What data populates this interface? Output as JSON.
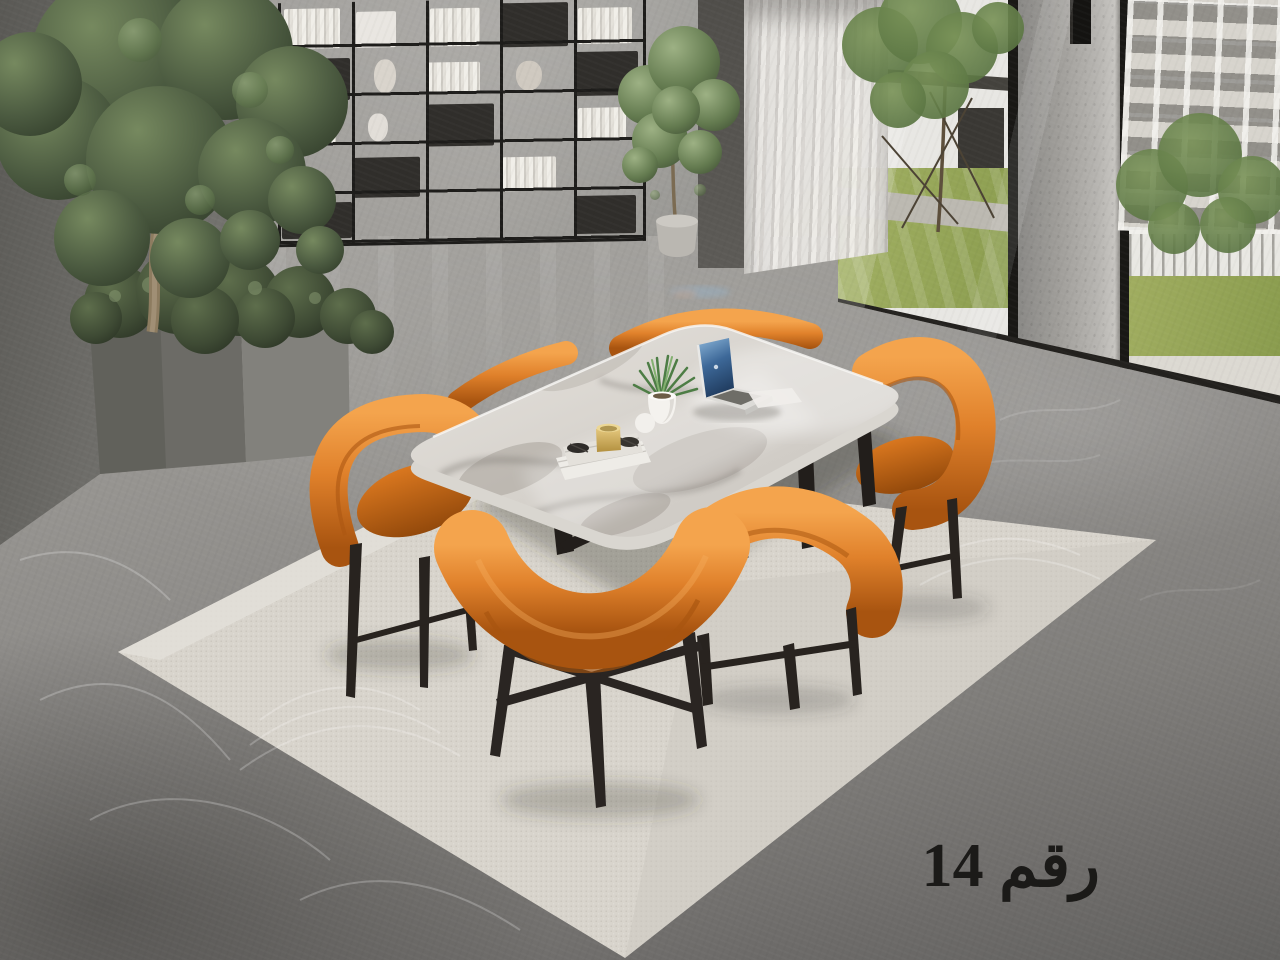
{
  "caption": {
    "text": "رقم 14"
  },
  "scene": {
    "setting": "Modern showroom dining corner with gray concrete walls, black grid display shelving, indoor tree in a concrete planter, sheer white curtain and floor-to-ceiling windows overlooking lawns and white apartment buildings",
    "furniture": {
      "table": "Gray marble-top dining table with rounded corners and black metal legs",
      "chairs": "Six curved-back orange leather dining chairs with black tapered metal legs",
      "rug": "Large light beige area rug with stitched arc pattern"
    },
    "tabletop_items": [
      "Open laptop with blue screen",
      "White ribbed pot with green spiky plant",
      "Stack of white books on a tray",
      "Gold candle cup",
      "Small white ball vase"
    ],
    "window_view": [
      "Green trees",
      "White multi-storey buildings",
      "White fence",
      "Lawn"
    ]
  },
  "colors": {
    "wall_gray": "#a3a19d",
    "wall_dark": "#5a5955",
    "floor_gray": "#8d8b88",
    "floor_dark": "#636260",
    "shelf_black": "#1d1c1a",
    "curtain_white": "#f0eeea",
    "frame_black": "#191815",
    "pillar_gray": "#a09e9a",
    "building_white": "#e8e7e3",
    "grass_green": "#8a9c4e",
    "rug_beige": "#d8d4cc",
    "chair_orange": "#e0812b",
    "chair_orange_dark": "#a85410",
    "chair_seat_orange": "#c06716",
    "leg_black": "#28231f",
    "marble_light": "#e6e3de",
    "marble_vein": "#a39d96",
    "laptop_screen_blue": "#3d6898",
    "candle_gold": "#c9a854",
    "plant_green": "#4d7d45",
    "indoor_foliage": "#4b5a40",
    "caption_black": "#1b1a18"
  }
}
